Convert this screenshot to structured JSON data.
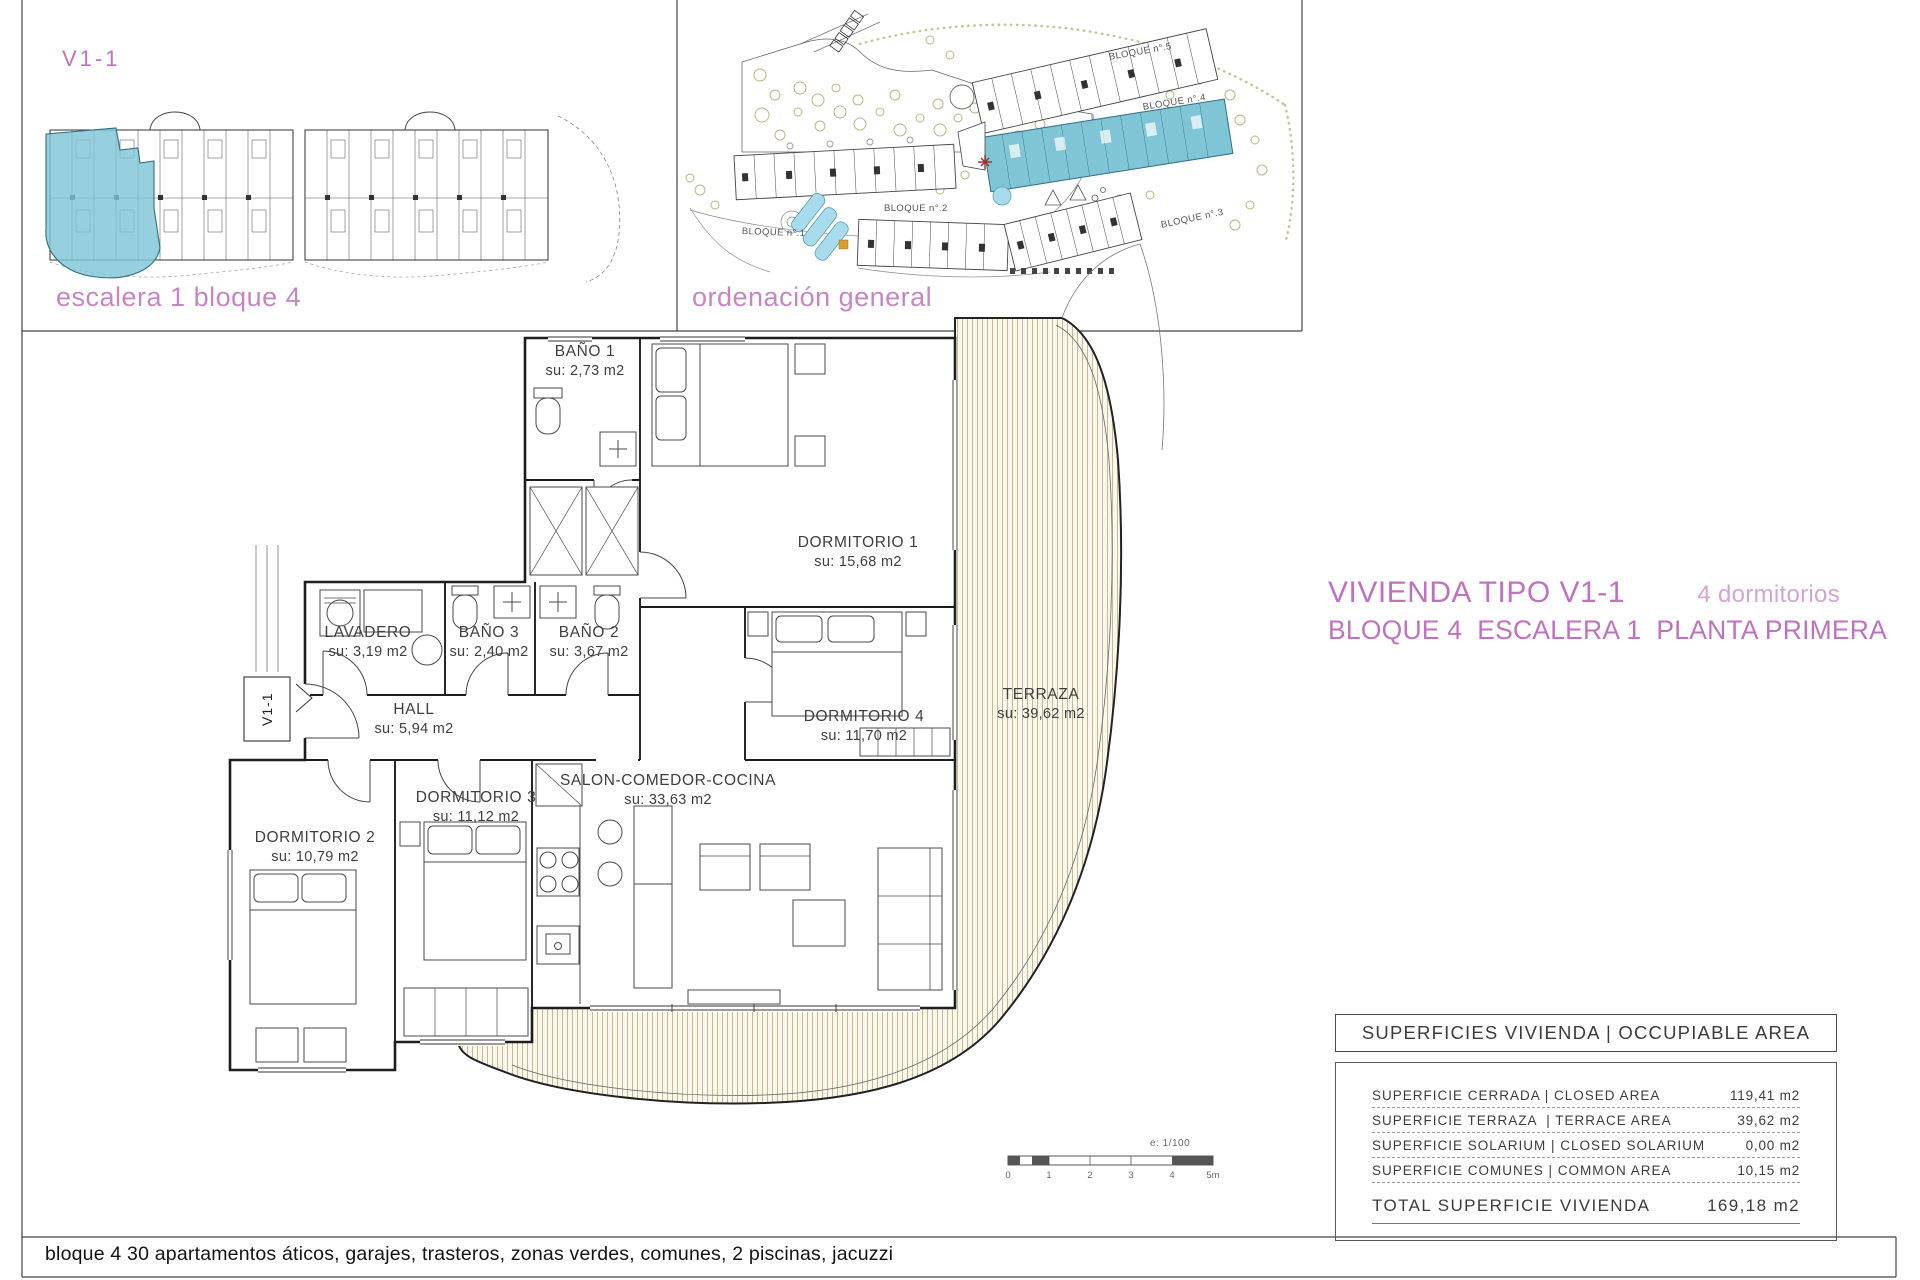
{
  "panel_unit": {
    "title": "V1-1",
    "caption": "escalera 1 bloque 4"
  },
  "panel_site": {
    "caption": "ordenación general",
    "block_labels": [
      "BLOQUE n°.5",
      "BLOQUE n°.4",
      "BLOQUE n°.3",
      "BLOQUE n°.2",
      "BLOQUE n°.1"
    ]
  },
  "title_block": {
    "type_title": "VIVIENDA TIPO V1-1",
    "bedrooms_note": "4 dormitorios",
    "location_line": "BLOQUE 4  ESCALERA 1  PLANTA PRIMERA"
  },
  "floorplan": {
    "unit_tag": "V1-1",
    "rooms": [
      {
        "name": "BAÑO 1",
        "area": "su: 2,73 m2"
      },
      {
        "name": "DORMITORIO 1",
        "area": "su: 15,68 m2"
      },
      {
        "name": "LAVADERO",
        "area": "su: 3,19 m2"
      },
      {
        "name": "BAÑO 3",
        "area": "su: 2,40 m2"
      },
      {
        "name": "BAÑO 2",
        "area": "su: 3,67 m2"
      },
      {
        "name": "HALL",
        "area": "su: 5,94 m2"
      },
      {
        "name": "DORMITORIO 4",
        "area": "su: 11,70 m2"
      },
      {
        "name": "TERRAZA",
        "area": "su: 39,62 m2"
      },
      {
        "name": "DORMITORIO 3",
        "area": "su: 11,12 m2"
      },
      {
        "name": "DORMITORIO 2",
        "area": "su: 10,79 m2"
      },
      {
        "name": "SALON-COMEDOR-COCINA",
        "area": "su: 33,63 m2"
      }
    ],
    "scale_note": "e: 1/100",
    "scale_ticks": [
      "0",
      "1",
      "2",
      "3",
      "4",
      "5m"
    ]
  },
  "areas_table": {
    "header": "SUPERFICIES VIVIENDA | OCCUPIABLE AREA",
    "rows": [
      {
        "label": "SUPERFICIE CERRADA | CLOSED AREA",
        "value": "119,41 m2"
      },
      {
        "label": "SUPERFICIE TERRAZA  | TERRACE AREA",
        "value": "39,62 m2"
      },
      {
        "label": "SUPERFICIE SOLARIUM | CLOSED SOLARIUM",
        "value": "0,00 m2"
      },
      {
        "label": "SUPERFICIE COMUNES | COMMON AREA",
        "value": "10,15 m2"
      }
    ],
    "total_label": "TOTAL SUPERFICIE VIVIENDA",
    "total_value": "169,18 m2"
  },
  "footer": {
    "note": "bloque 4 30 apartamentos áticos, garajes, trasteros, zonas verdes, comunes, 2 piscinas, jacuzzi"
  },
  "colors": {
    "accent_pink": "#bf72bf",
    "accent_pink_light": "#d2a5d2",
    "unit_highlight": "#7fc5d6",
    "pool": "#a8dcec",
    "tree": "#b9b583",
    "terrace_fill": "#faf7ec"
  }
}
